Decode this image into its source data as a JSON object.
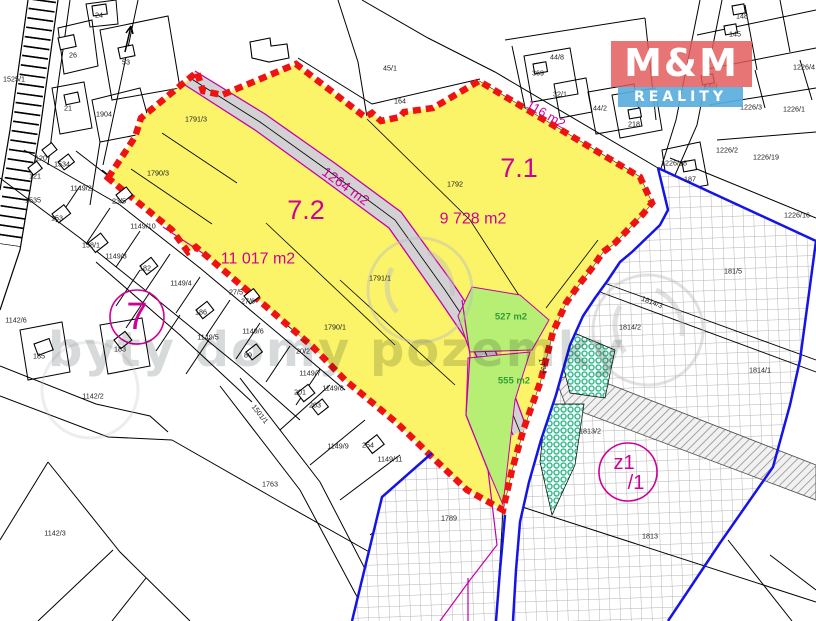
{
  "map": {
    "type": "cadastral-map",
    "colors": {
      "highlight_yellow": "#fbf469",
      "boundary_red": "#ee1212",
      "cadastre_magenta": "#c400a8",
      "label_magenta": "#cf0096",
      "green_area": "#b7ee74",
      "green_label": "#2f9e33",
      "teal_area": "#2db389",
      "zone_blue": "#1414e6",
      "road_gray": "#d3d1d3",
      "logo_red": "#e25a5a",
      "logo_blue": "#5aaede"
    },
    "labels": {
      "parcels": [
        {
          "t": "1525/1",
          "x": 14,
          "y": 79
        },
        {
          "t": "24",
          "x": 99,
          "y": 15
        },
        {
          "t": "26",
          "x": 73,
          "y": 55
        },
        {
          "t": "53",
          "x": 126,
          "y": 62
        },
        {
          "t": "21",
          "x": 68,
          "y": 108
        },
        {
          "t": "1904",
          "x": 104,
          "y": 114
        },
        {
          "t": "120",
          "x": 41,
          "y": 158
        },
        {
          "t": "1534",
          "x": 62,
          "y": 164
        },
        {
          "t": "121",
          "x": 35,
          "y": 176
        },
        {
          "t": "1535",
          "x": 33,
          "y": 200
        },
        {
          "t": "1149/2",
          "x": 81,
          "y": 188
        },
        {
          "t": "153",
          "x": 57,
          "y": 218
        },
        {
          "t": "23/5",
          "x": 119,
          "y": 201
        },
        {
          "t": "1149/10",
          "x": 143,
          "y": 226
        },
        {
          "t": "158/1",
          "x": 91,
          "y": 245
        },
        {
          "t": "1149/3",
          "x": 116,
          "y": 256
        },
        {
          "t": "182",
          "x": 145,
          "y": 268
        },
        {
          "t": "1149/4",
          "x": 181,
          "y": 283
        },
        {
          "t": "27/5",
          "x": 236,
          "y": 292
        },
        {
          "t": "27/6",
          "x": 248,
          "y": 301
        },
        {
          "t": "186",
          "x": 201,
          "y": 312
        },
        {
          "t": "1149/5",
          "x": 208,
          "y": 337
        },
        {
          "t": "1149/6",
          "x": 253,
          "y": 331
        },
        {
          "t": "89",
          "x": 248,
          "y": 355
        },
        {
          "t": "20/2",
          "x": 303,
          "y": 351
        },
        {
          "t": "1149/7",
          "x": 310,
          "y": 373
        },
        {
          "t": "201",
          "x": 300,
          "y": 392
        },
        {
          "t": "1149/8",
          "x": 333,
          "y": 388
        },
        {
          "t": "203",
          "x": 315,
          "y": 405
        },
        {
          "t": "1149/9",
          "x": 338,
          "y": 446
        },
        {
          "t": "254",
          "x": 368,
          "y": 445
        },
        {
          "t": "1149/11",
          "x": 390,
          "y": 459
        },
        {
          "t": "183",
          "x": 120,
          "y": 349
        },
        {
          "t": "185",
          "x": 39,
          "y": 356
        },
        {
          "t": "1142/6",
          "x": 16,
          "y": 320
        },
        {
          "t": "1142/2",
          "x": 93,
          "y": 396
        },
        {
          "t": "1142/3",
          "x": 55,
          "y": 533
        },
        {
          "t": "1763",
          "x": 270,
          "y": 484
        },
        {
          "t": "1791/3",
          "x": 196,
          "y": 119
        },
        {
          "t": "1790/3",
          "x": 158,
          "y": 173
        },
        {
          "t": "1792",
          "x": 455,
          "y": 184
        },
        {
          "t": "1791/1",
          "x": 380,
          "y": 278
        },
        {
          "t": "1790/1",
          "x": 335,
          "y": 327
        },
        {
          "t": "45/1",
          "x": 390,
          "y": 68
        },
        {
          "t": "164",
          "x": 400,
          "y": 101
        },
        {
          "t": "44/8",
          "x": 557,
          "y": 57
        },
        {
          "t": "369",
          "x": 538,
          "y": 73
        },
        {
          "t": "32/1",
          "x": 560,
          "y": 94
        },
        {
          "t": "44/2",
          "x": 600,
          "y": 108
        },
        {
          "t": "14/4",
          "x": 711,
          "y": 86
        },
        {
          "t": "148",
          "x": 742,
          "y": 16
        },
        {
          "t": "145",
          "x": 735,
          "y": 34
        },
        {
          "t": "218",
          "x": 634,
          "y": 124
        },
        {
          "t": "1226/4",
          "x": 804,
          "y": 67
        },
        {
          "t": "1226/3",
          "x": 751,
          "y": 107
        },
        {
          "t": "1226/1",
          "x": 794,
          "y": 109
        },
        {
          "t": "1226/2",
          "x": 727,
          "y": 150
        },
        {
          "t": "1226/19",
          "x": 766,
          "y": 157
        },
        {
          "t": "1226/18",
          "x": 674,
          "y": 163
        },
        {
          "t": "187",
          "x": 690,
          "y": 179
        },
        {
          "t": "1226/16",
          "x": 797,
          "y": 215
        },
        {
          "t": "181/5",
          "x": 733,
          "y": 271
        },
        {
          "t": "1814/2",
          "x": 630,
          "y": 327
        },
        {
          "t": "1814/1",
          "x": 760,
          "y": 370
        },
        {
          "t": "1814/3",
          "x": 652,
          "y": 302,
          "r": 21
        },
        {
          "t": "1813",
          "x": 650,
          "y": 536
        },
        {
          "t": "1813/2",
          "x": 590,
          "y": 431
        },
        {
          "t": "1789",
          "x": 449,
          "y": 518
        },
        {
          "t": "1794",
          "x": 543,
          "y": 366,
          "r": 75
        },
        {
          "t": "1501/1",
          "x": 260,
          "y": 414,
          "r": 52
        }
      ],
      "areas": [
        {
          "t": "7.1",
          "x": 519,
          "y": 168,
          "s": 27
        },
        {
          "t": "7.2",
          "x": 306,
          "y": 210,
          "s": 27
        },
        {
          "t": "9 728 m2",
          "x": 473,
          "y": 219,
          "s": 16
        },
        {
          "t": "11 017 m2",
          "x": 258,
          "y": 259,
          "s": 16
        },
        {
          "t": "1264 m2",
          "x": 346,
          "y": 186,
          "s": 14,
          "r": 36
        },
        {
          "t": "116 m2",
          "x": 546,
          "y": 114,
          "s": 13,
          "r": 30
        }
      ],
      "greens": [
        {
          "t": "527 m2",
          "x": 511,
          "y": 317,
          "s": 9.5
        },
        {
          "t": "555 m2",
          "x": 514,
          "y": 381,
          "s": 9.5
        }
      ],
      "rings": [
        {
          "cx": 137,
          "cy": 317,
          "r": 27,
          "fs": 38,
          "lines": [
            "7"
          ]
        },
        {
          "cx": 628,
          "cy": 472,
          "r": 29,
          "fs": 20,
          "lines": [
            "z1",
            "/1"
          ]
        }
      ]
    },
    "logo": {
      "line1": "M&M",
      "line2": "REALITY"
    },
    "watermark": {
      "text": "byty domy pozemky"
    }
  }
}
